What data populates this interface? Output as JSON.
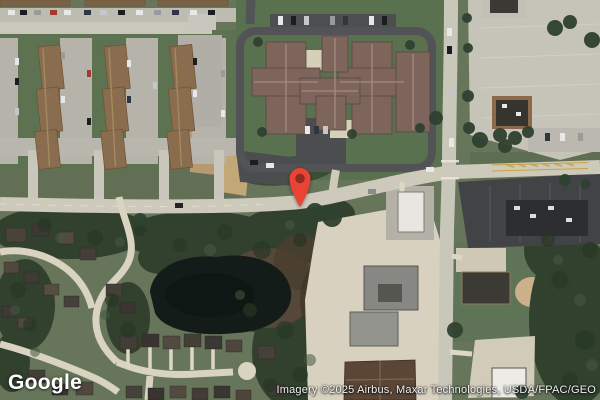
{
  "map": {
    "view": "satellite",
    "marker": {
      "color": "#EA4335",
      "inner_color": "#8F2B20",
      "tip_x": 300,
      "tip_y": 207
    },
    "palette": {
      "grass": "#67765A",
      "lawn": "#5A7150",
      "forest": "#31412E",
      "water": "#131C18",
      "marsh": "#55483A",
      "main_road": "#CDC9BB",
      "neighborhood_street": "#D9D3C1",
      "asphalt": "#4C4D4F",
      "parking": "#C6C3B8",
      "apartment_roof": "#8A6D4E",
      "complex_roof": "#7D655B"
    }
  },
  "branding": {
    "logo_text": "Google"
  },
  "attribution": {
    "text": "Imagery ©2025 Airbus, Maxar Technologies, USDA/FPAC/GEO"
  }
}
